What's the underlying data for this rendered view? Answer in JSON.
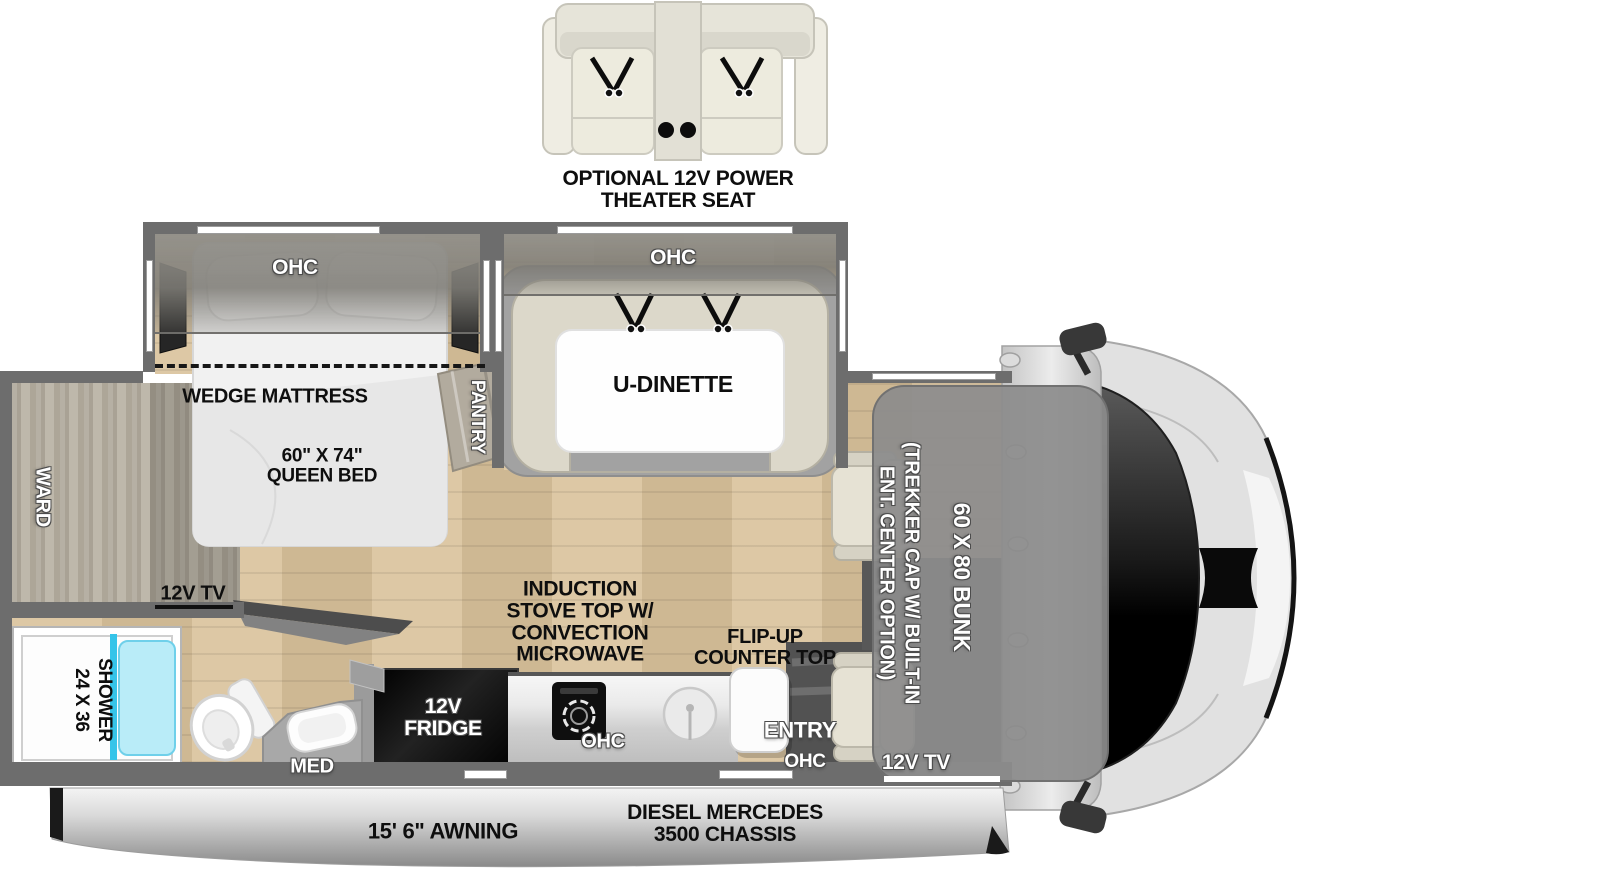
{
  "optional_seat": {
    "line1": "OPTIONAL 12V POWER",
    "line2": "THEATER SEAT"
  },
  "bedroom": {
    "ohc": "OHC",
    "slide_line": "WEDGE MATTRESS",
    "bed_size": "60\" X 74\"",
    "bed_type": "QUEEN BED",
    "tv": "12V TV",
    "ward": "WARD",
    "pantry": "PANTRY"
  },
  "dinette": {
    "ohc": "OHC",
    "label": "U-DINETTE"
  },
  "bathroom": {
    "shower_size": "24 X 36",
    "shower_label": "SHOWER",
    "med": "MED"
  },
  "kitchen": {
    "fridge_line1": "12V",
    "fridge_line2": "FRIDGE",
    "stove_line1": "INDUCTION",
    "stove_line2": "STOVE TOP W/",
    "stove_line3": "CONVECTION",
    "stove_line4": "MICROWAVE",
    "ohc": "OHC",
    "flip_line1": "FLIP-UP",
    "flip_line2": "COUNTER TOP"
  },
  "entry": {
    "label": "ENTRY",
    "ohc": "OHC"
  },
  "cab": {
    "bunk": "60 X 80 BUNK",
    "bunk_opt_line1": "(TREKKER CAP W/ BUILT-IN",
    "bunk_opt_line2": "ENT. CENTER OPTION)",
    "tv": "12V TV",
    "chassis_line1": "DIESEL MERCEDES",
    "chassis_line2": "3500 CHASSIS"
  },
  "exterior": {
    "awning": "15' 6\" AWNING"
  },
  "colors": {
    "wall": "#6d6d6d",
    "floor_wood": "#d9c29b",
    "shower_glass": "#b9ecf8",
    "bunk_overlay": "#8c8c8c",
    "label_black": "#0e0e0e",
    "label_white": "#ffffff"
  }
}
